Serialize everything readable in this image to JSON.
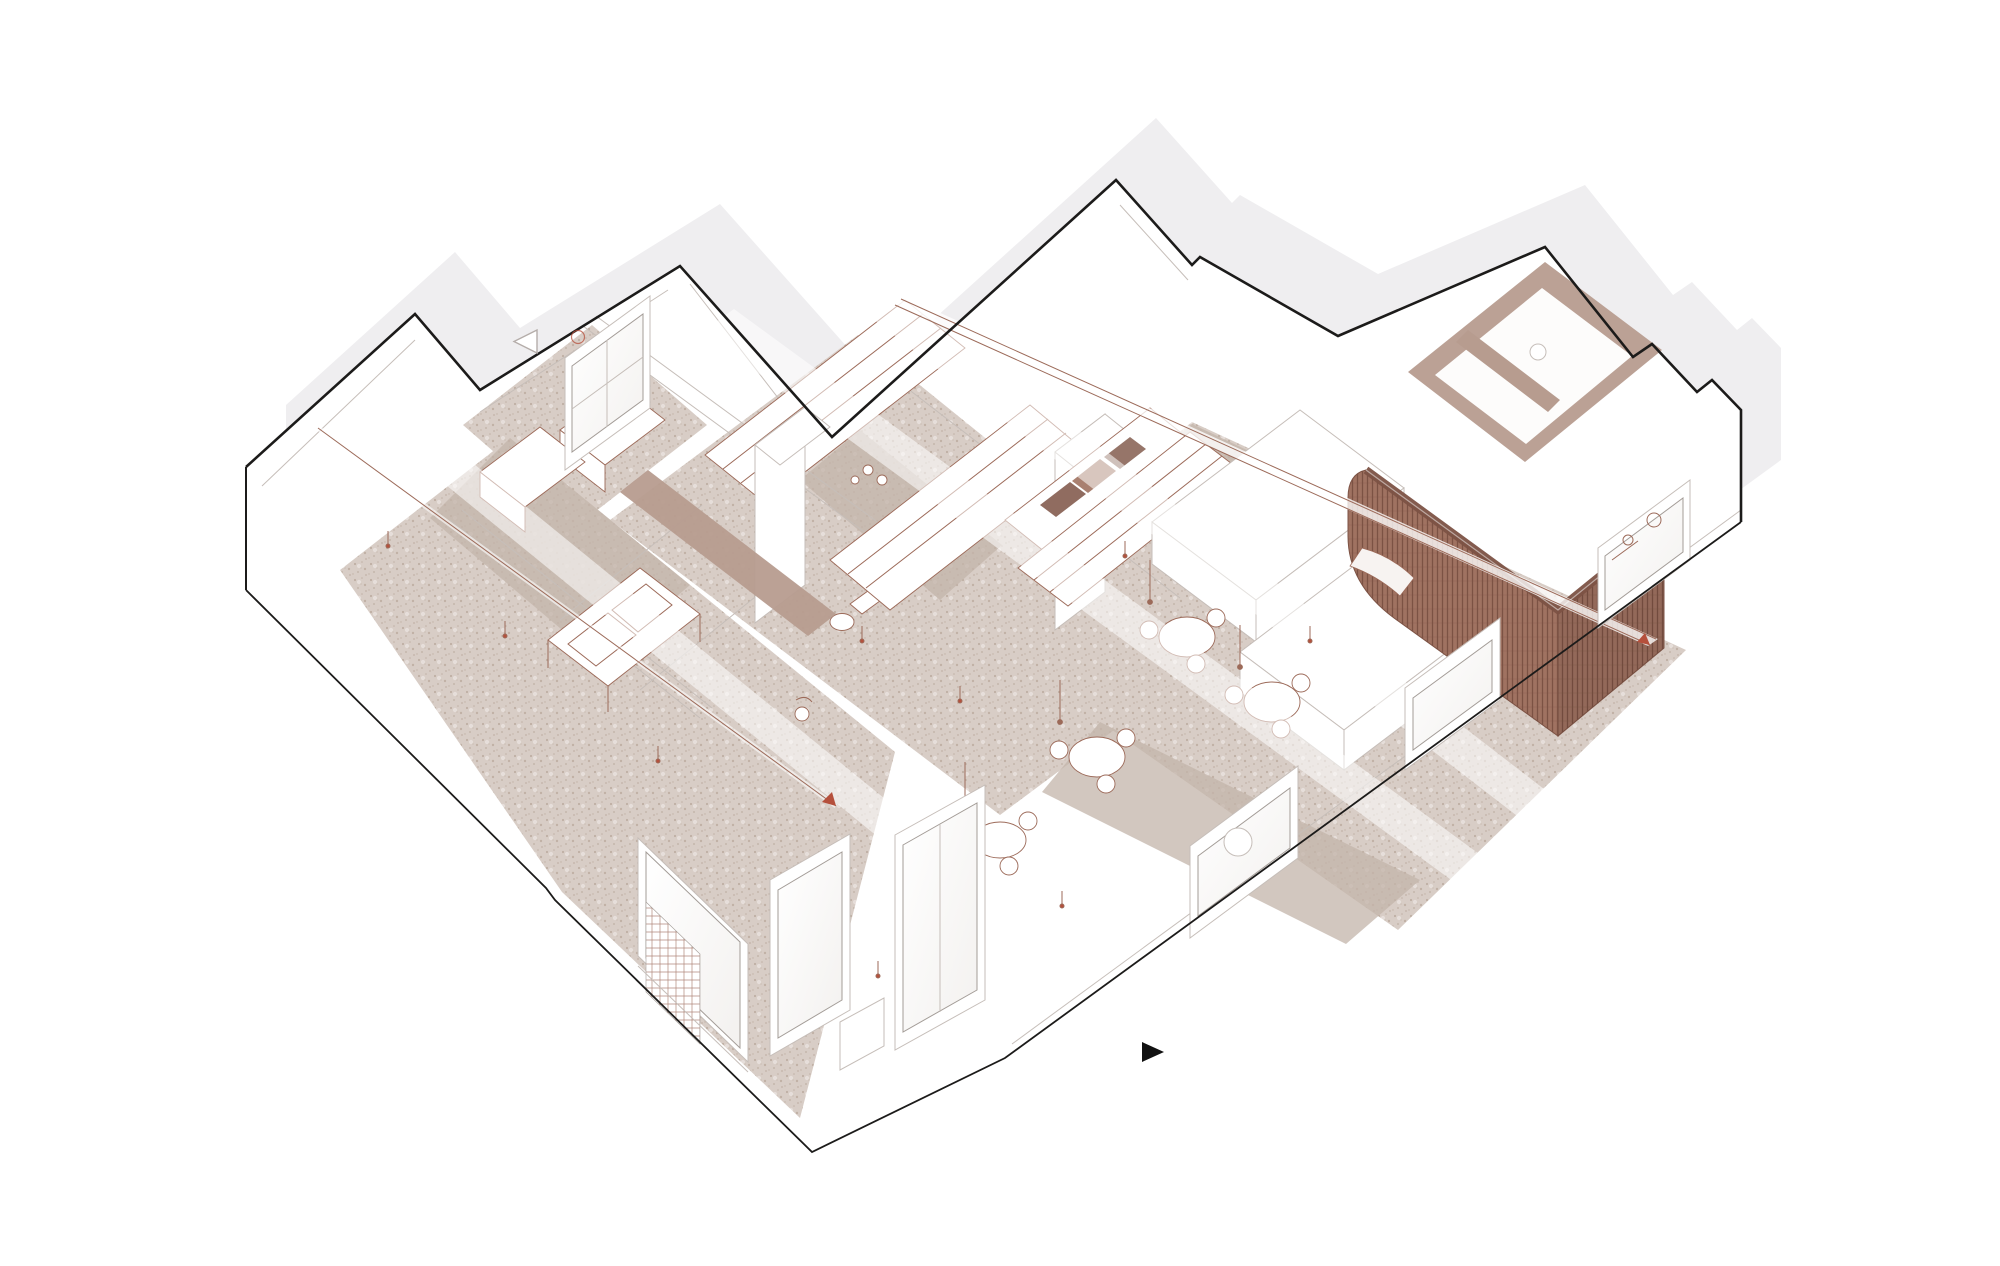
{
  "drawing": {
    "kind": "axonometric-cutaway-floor-plan",
    "width_px": 2000,
    "height_px": 1266
  },
  "colors": {
    "bg": "#ffffff",
    "shadow": "#efeef0",
    "outline": "#1c1b1a",
    "wallLine": "#c6beb9",
    "innerLine": "#d6cfca",
    "floor": "#d8cdc6",
    "floorDot": "#a99686",
    "floorShadow": "#c3b4aa",
    "sepia": "#9c6a59",
    "pod": "#a07261",
    "podDark": "#7c5244",
    "innerWall": "#b79c8f",
    "red": "#b5503c",
    "glass": "#f3f1ef",
    "black": "#111111"
  },
  "markers": {
    "section_arrow": "filled-triangle-right",
    "view_triangle": "outline-triangle-left",
    "utility_circle": "outline-circle"
  }
}
